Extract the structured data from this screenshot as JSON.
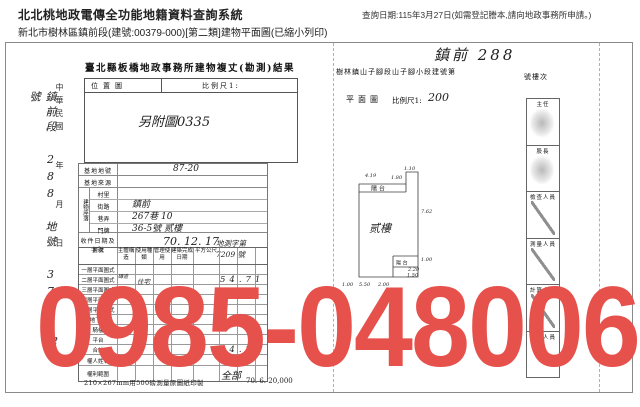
{
  "header": {
    "system_title": "北北桃地政電傳全功能地籍資料查詢系統",
    "subtitle": "新北市樹林區鎮前段(建號:00379-000)[第二類]建物平面圖(已縮小列印)",
    "query_date": "查詢日期:115年3月27日(如需登記謄本,請向地政事務所申請。)"
  },
  "watermark": {
    "text": "0985-048006",
    "color": "#e7514b"
  },
  "left_doc": {
    "title": "臺北縣板橋地政事務所建物複丈(勘測)結果",
    "margin": {
      "handwritten": "鎮前段 288 地號 379 建號",
      "printed": "中華民國　　年　　月　　日"
    },
    "location_box": {
      "map_label": "位置圖",
      "scale_label": "比例尺1:",
      "note": "另附圖0335"
    },
    "fields": {
      "site_no_label": "基地地號",
      "site_no_value": "87-20",
      "site_source_label": "基地來源",
      "address_label": "建物座落",
      "village_label": "村里",
      "village_value": "",
      "street_label": "街路",
      "street_value": "鎮前",
      "lane_label": "巷弄",
      "lane_value": "267巷 10",
      "door_label": "門牌",
      "door_value": "36-5號 贰樓",
      "receipt_label": "收件日期及字號",
      "receipt_date": "70. 12. 17",
      "receipt_no": "地測字第 7209 號"
    },
    "table": {
      "headers": [
        "層次",
        "主體構造",
        "使用種類",
        "管理使用",
        "建築完成日期",
        "平方公尺"
      ],
      "rows": [
        {
          "label": "一層平面圖式"
        },
        {
          "label": "二層平面圖式",
          "construction": "磚造",
          "use": "住宅",
          "area": "54.71"
        },
        {
          "label": "三層平面圖式"
        },
        {
          "label": "四層平面圖式"
        },
        {
          "label": "五層平面圖式"
        },
        {
          "label": "地下室"
        },
        {
          "label": "騎樓"
        },
        {
          "label": "平台"
        },
        {
          "label": "合計",
          "area": "54.71"
        }
      ],
      "owner_label": "權人姓名",
      "rights_label": "權利範圍",
      "rights_value": "全部"
    },
    "footer": {
      "note": "210×267mm用500磅測量原圖紙印製",
      "code": "70. 6. 20,000"
    }
  },
  "right_doc": {
    "handwritten_title": "鎮前 288",
    "header_prefix": "樹林鎮山子腳段山子腳小段建號第",
    "header_suffix": "號樓次",
    "plan_label": "平面圖",
    "scale_label": "比例尺1:",
    "scale_value": "200",
    "floor_label": "贰樓",
    "balcony_top": "陽 台",
    "balcony_bottom": "陽 台",
    "dims": {
      "top1": "4.19",
      "top2": "1.80",
      "top3": "1.10",
      "right": "7.62",
      "notch1": "1.00",
      "notch2": "2.20",
      "notch3": "1.50",
      "bottom1": "1.00",
      "bottom2": "5.50",
      "bottom3": "2.00"
    },
    "stamps": [
      "主任",
      "股長",
      "檢查人員",
      "測量人員",
      "計算人員",
      "複丈人員"
    ]
  }
}
